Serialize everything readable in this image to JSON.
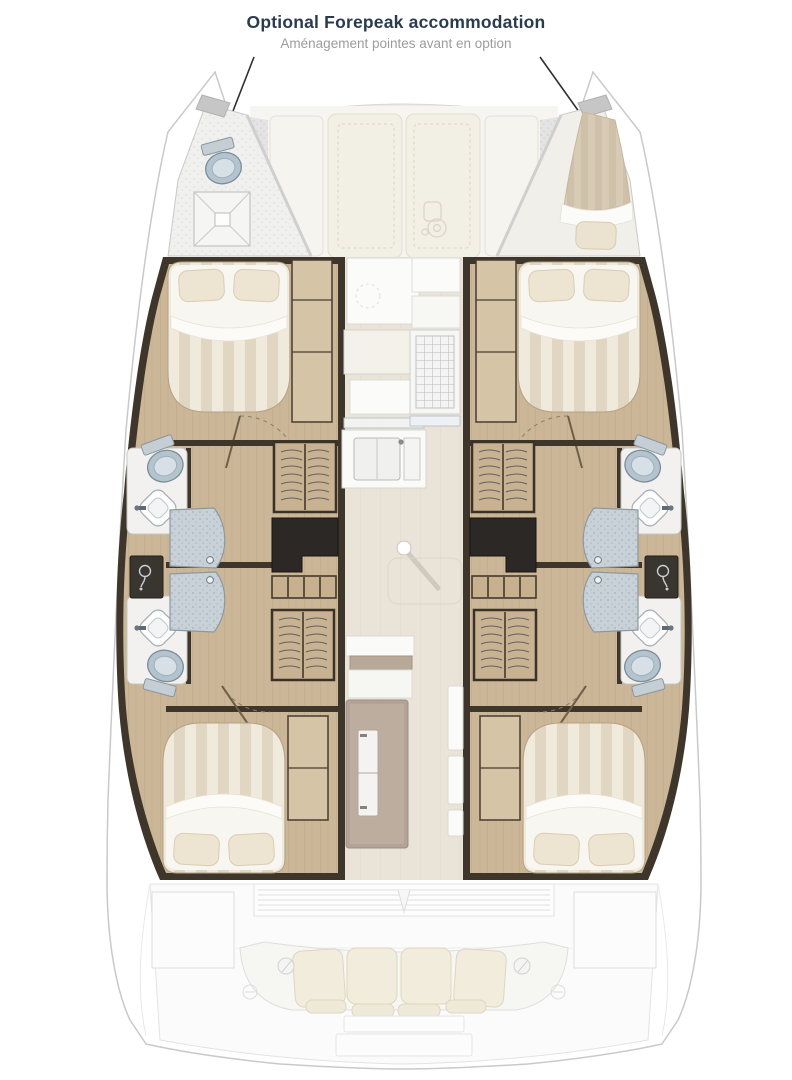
{
  "annotation": {
    "title": "Optional Forepeak accommodation",
    "subtitle": "Aménagement pointes avant en option"
  },
  "plan": {
    "type": "catamaran-accommodation-plan",
    "areas": {
      "port_forepeak": [
        "toilet",
        "shower-tray"
      ],
      "starboard_forepeak": [
        "single-berth",
        "pillow"
      ],
      "port_hull": [
        "double-berth-forward",
        "wardrobe",
        "bathroom-forward",
        "washbasin",
        "toilet",
        "shower-stall",
        "companionway-stairs-forward",
        "dark-counter",
        "shower-control-panel",
        "bathroom-aft",
        "companionway-stairs-aft",
        "double-berth-aft"
      ],
      "starboard_hull": [
        "double-berth-forward",
        "wardrobe",
        "bathroom-forward",
        "washbasin",
        "toilet",
        "shower-stall",
        "companionway-stairs-forward",
        "dark-counter",
        "shower-control-panel",
        "bathroom-aft",
        "companionway-stairs-aft",
        "double-berth-aft"
      ],
      "bridgedeck": [
        "foredeck-sunpads",
        "windlass",
        "galley-counter",
        "stove",
        "double-sink",
        "mast-post",
        "table-outline",
        "side-seats",
        "fridge-freezer"
      ],
      "cockpit": [
        "louvered-sliding-door",
        "storage-lockers",
        "bench-cushions",
        "winches",
        "transom-steps"
      ]
    }
  },
  "colors": {
    "background": "#ffffff",
    "title_color": "#2b3b4e",
    "subtitle_color": "#9c9c9c",
    "hull_outline": "#c9c9c9",
    "cabin_wall": "#3e352b",
    "wood_floor": "#cbb697",
    "light_wood": "#d6c4a6",
    "saloon_floor": "#eae4d8",
    "bed_stripe_light": "#f0eadd",
    "bed_stripe_dark": "#e1d6c1",
    "fixture_blue": "#b3c4cf",
    "shower_glass": "#c8d1d7",
    "dark_counter": "#2c2825",
    "cushion_cream": "#f1ecdc",
    "ghost_line": "#e3e3e3"
  }
}
